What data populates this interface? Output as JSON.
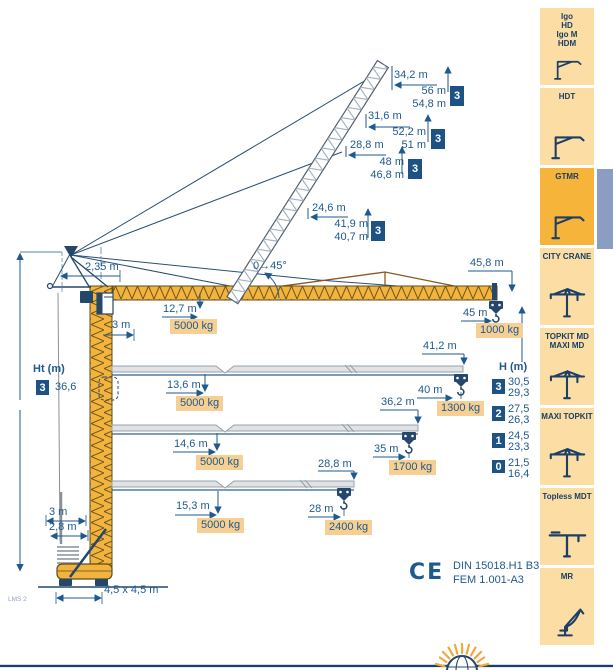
{
  "colors": {
    "accent_navy": "#1e5a8e",
    "badge_bg": "#1d5384",
    "highlight_bg": "#f7cf92",
    "crane_yellow": "#f2b33f",
    "sidebar_item_bg": "#fcdda4",
    "sidebar_active_bg": "#f6b43a",
    "active_tab": "#8b9ec1"
  },
  "sidebar": {
    "items": [
      {
        "lines": [
          "Igo",
          "HD",
          "Igo M",
          "HDM"
        ],
        "icon": "self-erecting-crane-icon",
        "active": false
      },
      {
        "lines": [
          "HDT"
        ],
        "icon": "self-erecting-crane-icon",
        "active": false
      },
      {
        "lines": [
          "GTMR"
        ],
        "icon": "self-erecting-crane-icon",
        "active": true
      },
      {
        "lines": [
          "CITY CRANE"
        ],
        "icon": "tower-crane-icon",
        "active": false
      },
      {
        "lines": [
          "TOPKIT MD",
          "MAXI MD"
        ],
        "icon": "tower-crane-icon",
        "active": false
      },
      {
        "lines": [
          "MAXI TOPKIT"
        ],
        "icon": "tower-crane-icon",
        "active": false
      },
      {
        "lines": [
          "Topless MDT"
        ],
        "icon": "topless-crane-icon",
        "active": false
      },
      {
        "lines": [
          "MR"
        ],
        "icon": "luffing-crane-icon",
        "active": false
      }
    ]
  },
  "diagram": {
    "angle_label": "0→45°",
    "counter_jib": "2,35 m",
    "cab_offset": "3 m",
    "jib_tip": "45,8 m",
    "raised": [
      {
        "radius": "34,2 m",
        "h1": "56 m",
        "h2": "54,8 m",
        "badge": "3"
      },
      {
        "radius": "31,6 m",
        "h1": "52,2 m",
        "h2": "51 m",
        "badge": "3"
      },
      {
        "radius": "28,8 m",
        "h1": "48 m",
        "h2": "46,8 m",
        "badge": "3"
      },
      {
        "radius": "24,6 m",
        "h1": "41,9 m",
        "h2": "40,7 m",
        "badge": "3"
      }
    ],
    "configs": [
      {
        "load_radius": "12,7 m",
        "max_load": "5000 kg",
        "tip_radius": "45 m",
        "tip_load": "1000 kg"
      },
      {
        "reach": "41,2 m",
        "load_radius": "13,6 m",
        "max_load": "5000 kg",
        "tip_radius": "40 m",
        "tip_load": "1300 kg"
      },
      {
        "reach": "36,2 m",
        "load_radius": "14,6 m",
        "max_load": "5000 kg",
        "tip_radius": "35 m",
        "tip_load": "1700 kg"
      },
      {
        "reach": "28,8 m",
        "load_radius": "15,3 m",
        "max_load": "5000 kg",
        "tip_radius": "28 m",
        "tip_load": "2400 kg"
      }
    ],
    "tower": {
      "label": "Ht (m)",
      "badge": "3",
      "value": "36,6"
    },
    "hook_height": {
      "label": "H (m)",
      "rows": [
        {
          "badge": "3",
          "v1": "30,5",
          "v2": "29,3"
        },
        {
          "badge": "2",
          "v1": "27,5",
          "v2": "26,3"
        },
        {
          "badge": "1",
          "v1": "24,5",
          "v2": "23,3"
        },
        {
          "badge": "0",
          "v1": "21,5",
          "v2": "16,4"
        }
      ]
    },
    "base": {
      "d1": "3 m",
      "d2": "2,8 m",
      "footprint": "4,5 x 4,5 m",
      "ref": "LMS 2"
    },
    "cert": {
      "mark": "CE",
      "line1": "DIN 15018.H1 B3",
      "line2": "FEM 1.001-A3"
    }
  }
}
